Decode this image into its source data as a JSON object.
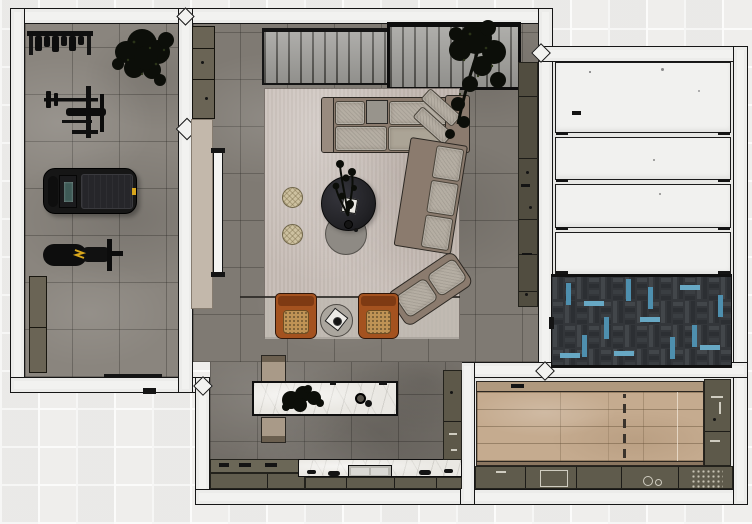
{
  "scene": {
    "type": "floor-plan-render",
    "view": "top-down-3d",
    "description": "Rendered top-down floor plan of an apartment with home gym, living room, kitchen, wardrobe room and utility room"
  },
  "colors": {
    "background_tile": "#efeeec",
    "background_grout": "#fbfbfa",
    "wall_fill": "#f2f2f0",
    "wall_line": "#161616",
    "concrete_gym": "#8a857e",
    "concrete_living": "#7f7a73",
    "rug": "#c6bcb5",
    "rug_band": "#bdb8b0",
    "rug_line": "#2a2825",
    "sofa_frame": "#8b7b6e",
    "sofa_cushion": "#b5aea3",
    "table_dark": "#232327",
    "table_gray": "#8e8a84",
    "pouf": "#cdc1a0",
    "armchair": "#a4521f",
    "armchair_dark": "#7e3a13",
    "armchair_cushion": "#bf9355",
    "marble": "#eae8e3",
    "counter_olive": "#615d4e",
    "counter_olive_dark": "#514d40",
    "counter_divider": "#23221c",
    "bench": "#a99a88",
    "bench_dark": "#6b5f4f",
    "cabinet_olive": "#6a6455",
    "cabinet_beige": "#c3b8ab",
    "door_white": "#f4f4f2",
    "panel_white": "#f1f1ef",
    "panel_gap": "#1b1b1b",
    "room_floor_light": "#e7e7e4",
    "herringbone_dark": "#33363a",
    "herringbone_mid": "#42464a",
    "herringbone_deep": "#2c2f33",
    "herringbone_blue": "#4e8fae",
    "herringbone_blue_light": "#67a8c4",
    "wood_floor": "#c5ab8f",
    "wood_band": "#b0997e",
    "wood_band_dark": "#8b7660",
    "equipment_black": "#161616",
    "equipment_deck": "#26262a",
    "screen_teal": "#3e5a56",
    "accent_yellow": "#d8a61c",
    "plant_dark": "#0c0e09",
    "plant_leaf": "#2a3318",
    "slat_fill": "#9d9c98",
    "slat_line": "#52514d",
    "sink_metal": "#d9d8d4"
  },
  "rooms": [
    {
      "name": "home-gym",
      "furniture": [
        "dumbbell-rack",
        "weight-machine",
        "treadmill",
        "weight-bench",
        "storage-cabinet",
        "potted-tree"
      ]
    },
    {
      "name": "living-room",
      "furniture": [
        "slatted-console-left",
        "slatted-console-right",
        "area-rug",
        "corner-sectional-sofa",
        "round-coffee-table",
        "round-nesting-table",
        "ottoman",
        "ottoman",
        "lounge-chair",
        "lounge-chair",
        "round-side-table",
        "potted-tree-large",
        "wall-counter-strip",
        "sliding-door",
        "beige-cabinet-band",
        "olive-wall-cabinet"
      ]
    },
    {
      "name": "kitchen",
      "furniture": [
        "kitchen-island",
        "island-plant",
        "island-bench-top",
        "island-bench-bottom",
        "cooktop-counter",
        "marble-sink-counter",
        "tall-cabinet"
      ]
    },
    {
      "name": "wardrobe-room",
      "furniture": [
        "white-panel-1",
        "white-panel-2",
        "white-panel-3",
        "white-panel-4",
        "herringbone-rug"
      ]
    },
    {
      "name": "utility-room",
      "furniture": [
        "wood-platform-floor",
        "side-counter",
        "bottom-counter",
        "counter-sink"
      ]
    }
  ]
}
